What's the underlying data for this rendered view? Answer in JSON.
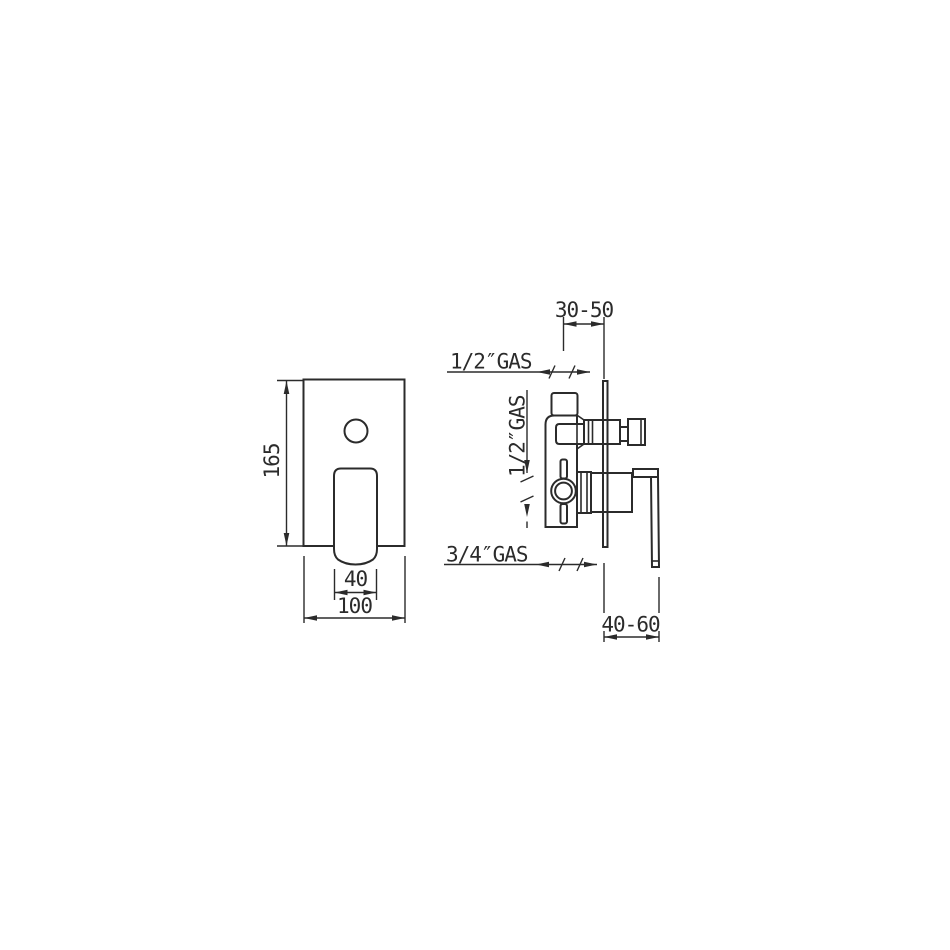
{
  "drawing": {
    "title": "concealed-shower-mixer-technical-drawing",
    "colors": {
      "line": "#2b2b2b",
      "background": "#ffffff"
    },
    "front_view": {
      "height_label": "165",
      "handle_width_label": "40",
      "plate_width_label": "100"
    },
    "side_view": {
      "wall_depth_label": "30-50",
      "top_inlet_label": "1/2″GAS",
      "side_outlet_label": "1/2″GAS",
      "bottom_outlet_label": "3/4″GAS",
      "lever_depth_label": "40-60"
    }
  }
}
